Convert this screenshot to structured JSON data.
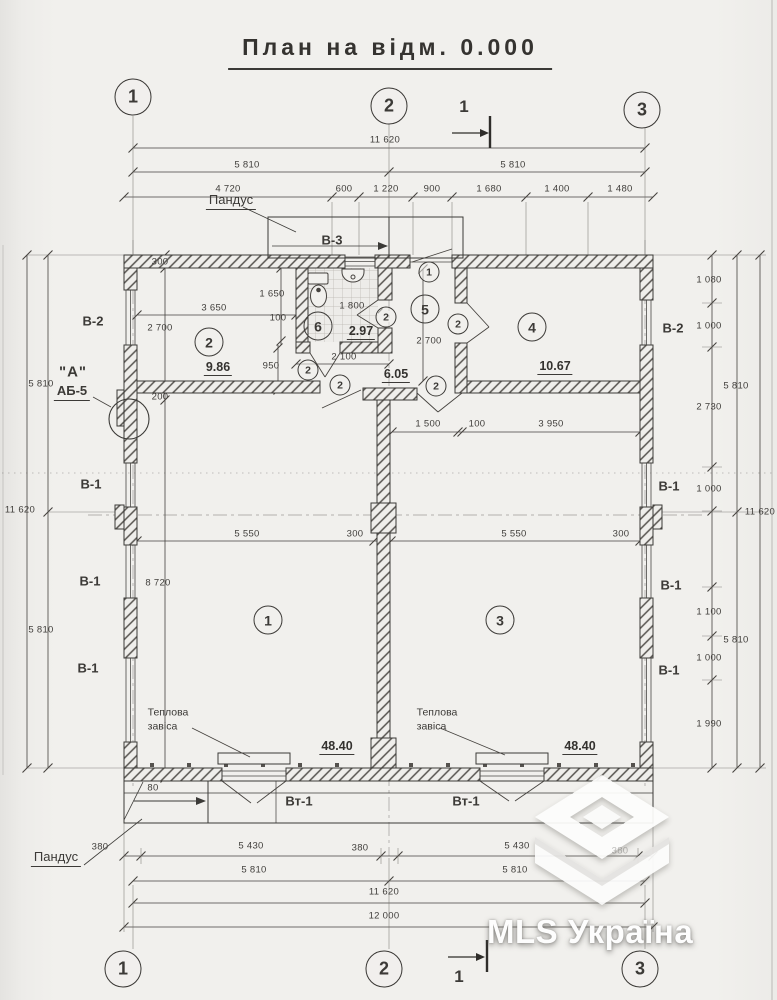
{
  "title": "План на відм. 0.000",
  "watermark": {
    "text": "MLS Україна"
  },
  "grid_top": [
    {
      "n": "1",
      "x": 133,
      "y": 97
    },
    {
      "n": "2",
      "x": 389,
      "y": 106
    },
    {
      "n": "3",
      "x": 642,
      "y": 110
    }
  ],
  "grid_bottom": [
    {
      "n": "1",
      "x": 123,
      "y": 969
    },
    {
      "n": "2",
      "x": 384,
      "y": 969
    },
    {
      "n": "3",
      "x": 640,
      "y": 969
    }
  ],
  "sections": [
    {
      "t": "1",
      "x": 464,
      "y": 107
    },
    {
      "t": "1",
      "x": 459,
      "y": 977
    }
  ],
  "rooms": [
    {
      "n": "1",
      "x": 268,
      "y": 620
    },
    {
      "n": "2",
      "x": 209,
      "y": 342
    },
    {
      "n": "3",
      "x": 500,
      "y": 620
    },
    {
      "n": "4",
      "x": 532,
      "y": 327
    },
    {
      "n": "5",
      "x": 425,
      "y": 309
    },
    {
      "n": "6",
      "x": 318,
      "y": 326
    }
  ],
  "areas": [
    {
      "t": "9.86",
      "x": 218,
      "y": 368
    },
    {
      "t": "2.97",
      "x": 361,
      "y": 332
    },
    {
      "t": "6.05",
      "x": 396,
      "y": 375
    },
    {
      "t": "10.67",
      "x": 555,
      "y": 367
    },
    {
      "t": "48.40",
      "x": 337,
      "y": 747
    },
    {
      "t": "48.40",
      "x": 580,
      "y": 747
    }
  ],
  "marks": [
    {
      "n": "1",
      "x": 429,
      "y": 272
    },
    {
      "n": "2",
      "x": 386,
      "y": 317
    },
    {
      "n": "2",
      "x": 458,
      "y": 324
    },
    {
      "n": "2",
      "x": 308,
      "y": 370
    },
    {
      "n": "2",
      "x": 340,
      "y": 385
    },
    {
      "n": "2",
      "x": 436,
      "y": 386
    }
  ],
  "labels": [
    {
      "t": "Пандус",
      "x": 231,
      "y": 201,
      "k": "lbl u"
    },
    {
      "t": "В-3",
      "x": 332,
      "y": 240,
      "k": "lbl bold"
    },
    {
      "t": "В-2",
      "x": 93,
      "y": 321,
      "k": "lbl bold"
    },
    {
      "t": "\"А\"",
      "x": 73,
      "y": 372,
      "k": "big"
    },
    {
      "t": "АБ-5",
      "x": 72,
      "y": 392,
      "k": "lbl bold u"
    },
    {
      "t": "В-1",
      "x": 91,
      "y": 484,
      "k": "lbl bold"
    },
    {
      "t": "В-1",
      "x": 90,
      "y": 581,
      "k": "lbl bold"
    },
    {
      "t": "В-1",
      "x": 88,
      "y": 668,
      "k": "lbl bold"
    },
    {
      "t": "В-2",
      "x": 673,
      "y": 328,
      "k": "lbl bold"
    },
    {
      "t": "В-1",
      "x": 669,
      "y": 486,
      "k": "lbl bold"
    },
    {
      "t": "В-1",
      "x": 671,
      "y": 585,
      "k": "lbl bold"
    },
    {
      "t": "В-1",
      "x": 669,
      "y": 670,
      "k": "lbl bold"
    },
    {
      "t": "Вт-1",
      "x": 299,
      "y": 801,
      "k": "lbl bold"
    },
    {
      "t": "Вт-1",
      "x": 466,
      "y": 801,
      "k": "lbl bold"
    },
    {
      "t": "Теплова\nзавіса",
      "x": 168,
      "y": 720,
      "k": "two"
    },
    {
      "t": "Теплова\nзавіса",
      "x": 437,
      "y": 720,
      "k": "two"
    },
    {
      "t": "Пандус",
      "x": 56,
      "y": 858,
      "k": "lbl u"
    }
  ],
  "dims": [
    {
      "t": "11 620",
      "x": 385,
      "y": 140
    },
    {
      "t": "5 810",
      "x": 247,
      "y": 165
    },
    {
      "t": "5 810",
      "x": 513,
      "y": 165
    },
    {
      "t": "4 720",
      "x": 228,
      "y": 189
    },
    {
      "t": "600",
      "x": 344,
      "y": 189
    },
    {
      "t": "1 220",
      "x": 386,
      "y": 189
    },
    {
      "t": "900",
      "x": 432,
      "y": 189
    },
    {
      "t": "1 680",
      "x": 489,
      "y": 189
    },
    {
      "t": "1 400",
      "x": 557,
      "y": 189
    },
    {
      "t": "1 480",
      "x": 620,
      "y": 189
    },
    {
      "t": "11 620",
      "x": 20,
      "y": 510,
      "r": 1
    },
    {
      "t": "5 810",
      "x": 41,
      "y": 384,
      "r": 1
    },
    {
      "t": "5 810",
      "x": 41,
      "y": 630,
      "r": 1
    },
    {
      "t": "300",
      "x": 160,
      "y": 262,
      "r": 1
    },
    {
      "t": "2 700",
      "x": 160,
      "y": 328,
      "r": 1
    },
    {
      "t": "200",
      "x": 160,
      "y": 397,
      "r": 1
    },
    {
      "t": "8 720",
      "x": 158,
      "y": 583,
      "r": 1
    },
    {
      "t": "3 650",
      "x": 214,
      "y": 308
    },
    {
      "t": "1 650",
      "x": 272,
      "y": 294,
      "r": 1
    },
    {
      "t": "100",
      "x": 278,
      "y": 318,
      "r": 1
    },
    {
      "t": "950",
      "x": 271,
      "y": 366,
      "r": 1
    },
    {
      "t": "1 800",
      "x": 352,
      "y": 306
    },
    {
      "t": "2 100",
      "x": 344,
      "y": 357
    },
    {
      "t": "2 700",
      "x": 429,
      "y": 341,
      "r": 1
    },
    {
      "t": "1 500",
      "x": 428,
      "y": 424
    },
    {
      "t": "100",
      "x": 477,
      "y": 424
    },
    {
      "t": "3 950",
      "x": 551,
      "y": 424
    },
    {
      "t": "5 550",
      "x": 247,
      "y": 534
    },
    {
      "t": "300",
      "x": 355,
      "y": 534
    },
    {
      "t": "5 550",
      "x": 514,
      "y": 534
    },
    {
      "t": "300",
      "x": 621,
      "y": 534
    },
    {
      "t": "1 080",
      "x": 709,
      "y": 280,
      "r": 1
    },
    {
      "t": "1 000",
      "x": 709,
      "y": 326,
      "r": 1
    },
    {
      "t": "2 730",
      "x": 709,
      "y": 407,
      "r": 1
    },
    {
      "t": "1 000",
      "x": 709,
      "y": 489,
      "r": 1
    },
    {
      "t": "1 100",
      "x": 709,
      "y": 612,
      "r": 1
    },
    {
      "t": "1 000",
      "x": 709,
      "y": 658,
      "r": 1
    },
    {
      "t": "1 990",
      "x": 709,
      "y": 724,
      "r": 1
    },
    {
      "t": "5 810",
      "x": 736,
      "y": 386,
      "r": 1
    },
    {
      "t": "5 810",
      "x": 736,
      "y": 640,
      "r": 1
    },
    {
      "t": "11 620",
      "x": 760,
      "y": 512,
      "r": 1
    },
    {
      "t": "80",
      "x": 153,
      "y": 788,
      "r": 1
    },
    {
      "t": "380",
      "x": 100,
      "y": 847
    },
    {
      "t": "5 430",
      "x": 251,
      "y": 846
    },
    {
      "t": "380",
      "x": 360,
      "y": 848
    },
    {
      "t": "5 430",
      "x": 517,
      "y": 846
    },
    {
      "t": "380",
      "x": 620,
      "y": 851,
      "f": 1
    },
    {
      "t": "5 810",
      "x": 254,
      "y": 870
    },
    {
      "t": "5 810",
      "x": 515,
      "y": 870
    },
    {
      "t": "11 620",
      "x": 384,
      "y": 892
    },
    {
      "t": "12 000",
      "x": 384,
      "y": 916
    }
  ],
  "colors": {
    "paper": "#f1f0ed",
    "line": "#3b3a37",
    "dim_line": "#45423e",
    "watermark": "#ffffff"
  }
}
